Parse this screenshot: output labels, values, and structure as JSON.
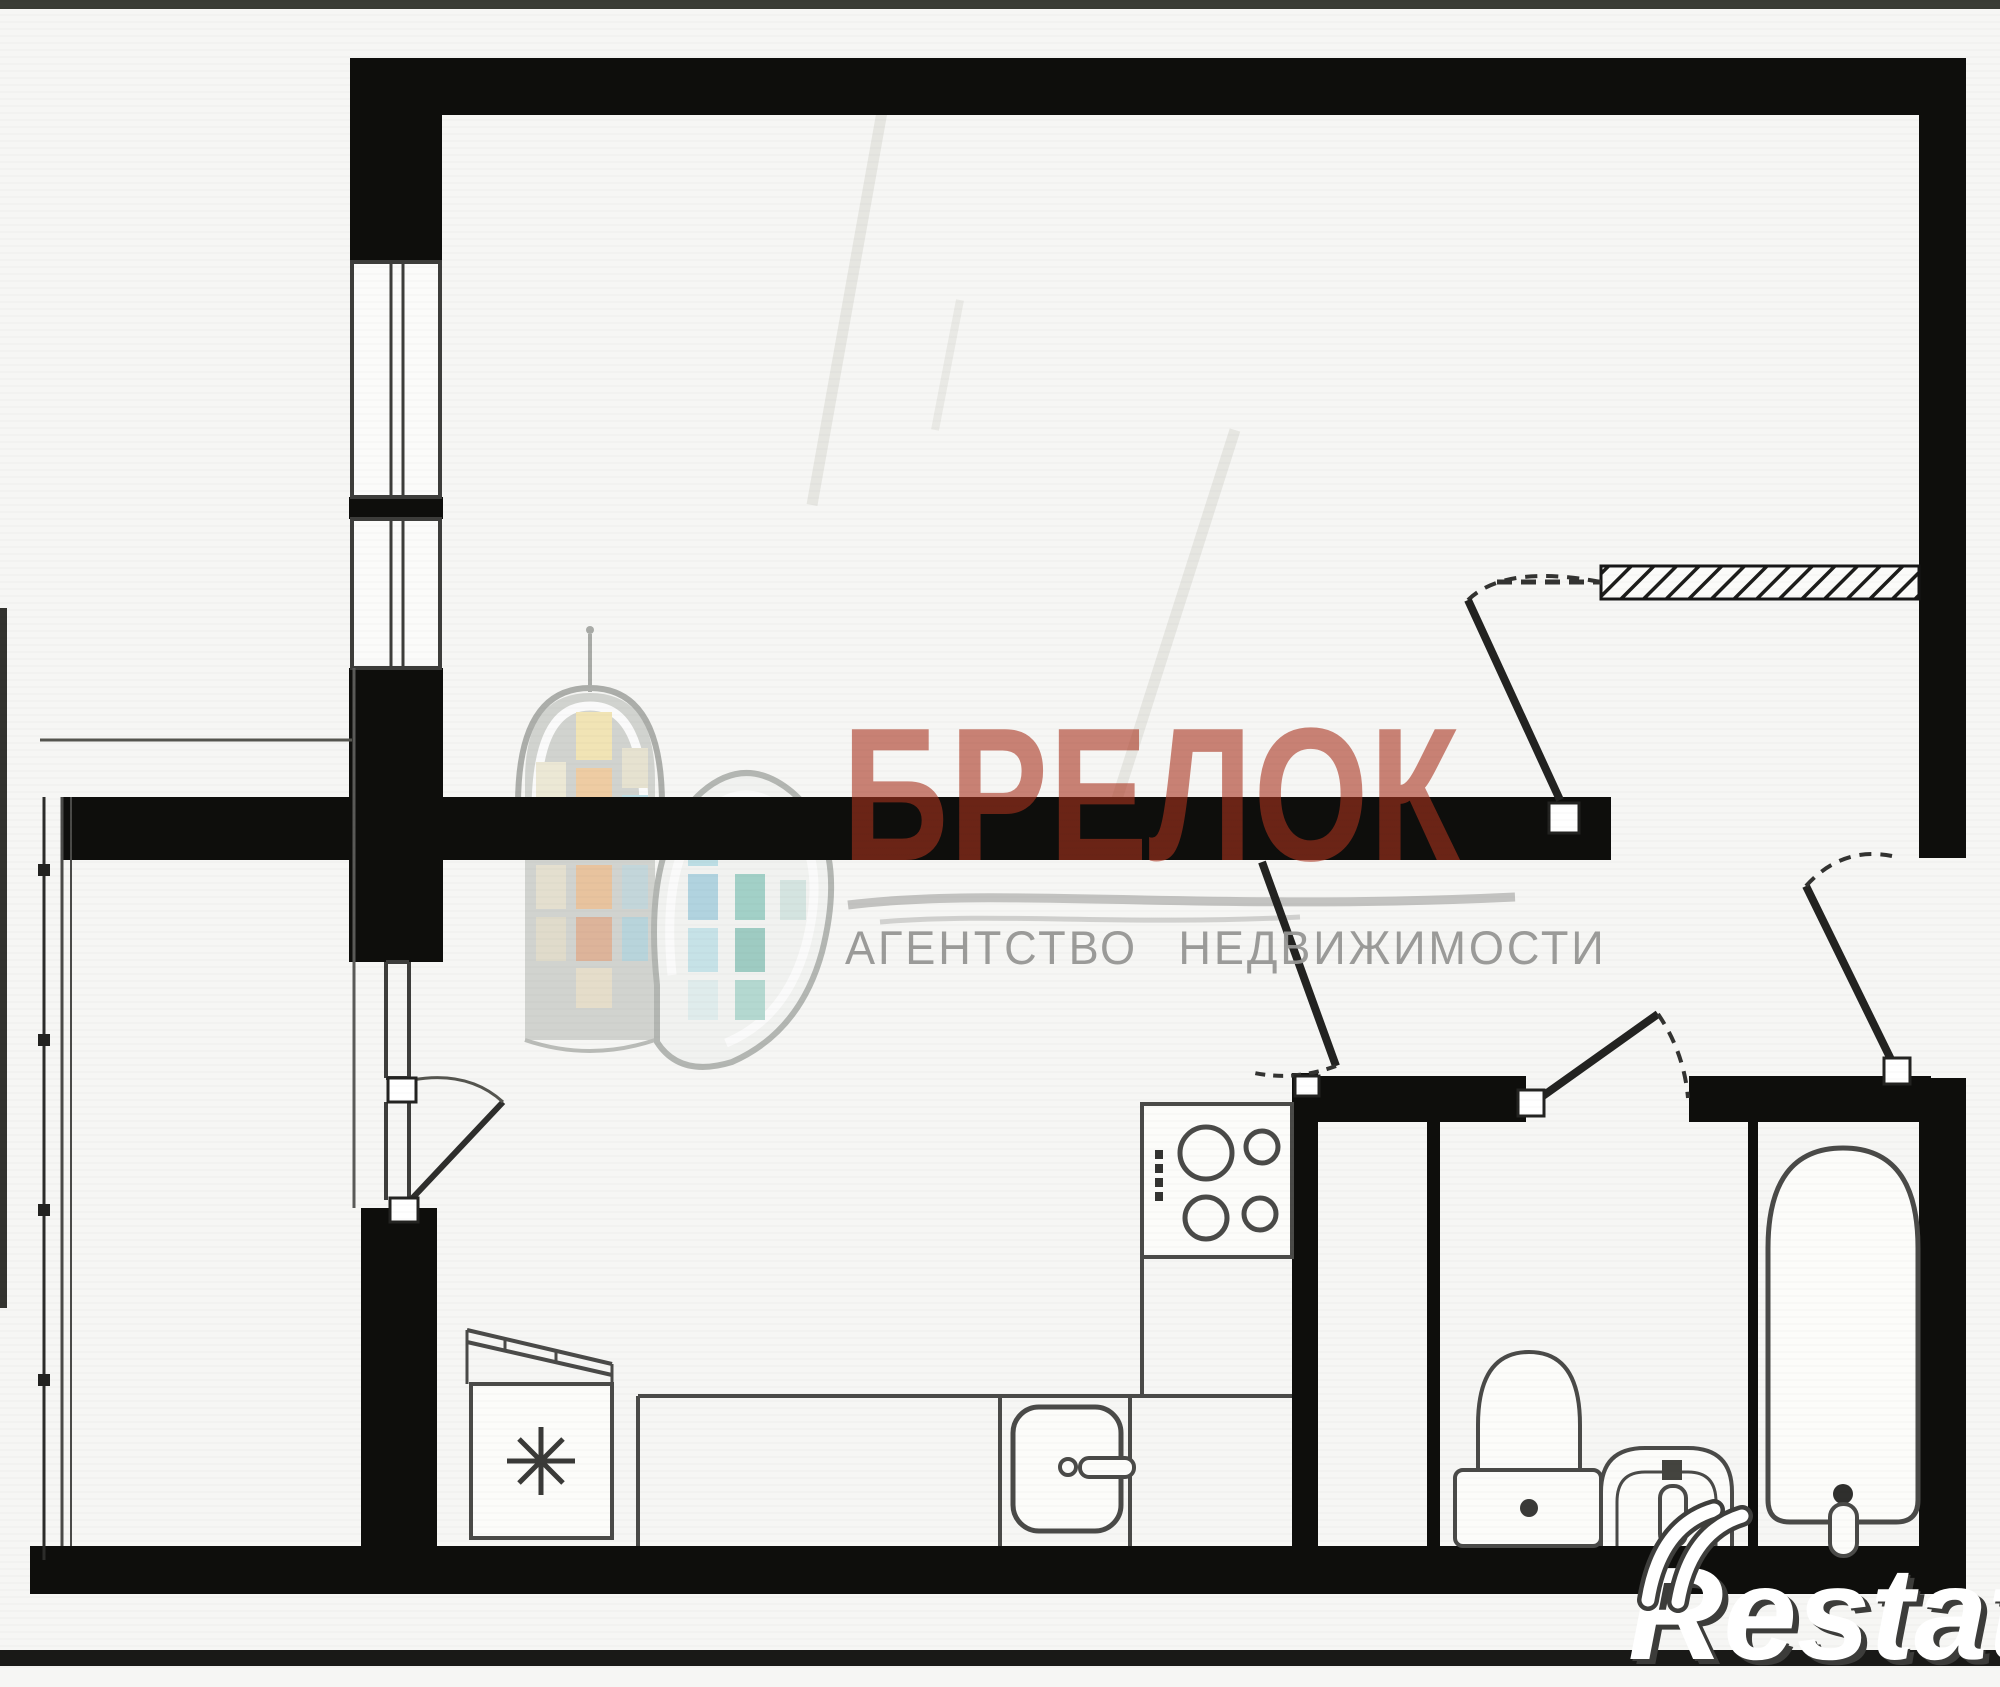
{
  "page": {
    "width": 2000,
    "height": 1669,
    "background": "#f6f6f4"
  },
  "watermark": {
    "brand_text": "БРЕЛОК",
    "tagline_text": "АГЕНТСТВО НЕДВИЖИМОСТИ",
    "brand_color": "rgba(170,52,30,0.60)",
    "tagline_color": "rgba(150,150,148,0.95)"
  },
  "agency_logo": {
    "name": "building-towers-logo",
    "window_colors": [
      "#eed783",
      "#e8aa62",
      "#8ec9d8",
      "#5fb2a4"
    ]
  },
  "corner_logo": {
    "text": "Restate",
    "fill": "#ffffff",
    "shadow": "#3c3c3a"
  },
  "floor_plan": {
    "wall_color": "#0e0e0c",
    "line_color": "#4a4a48",
    "elements": [
      "balcony",
      "living-room",
      "kitchen",
      "hallway",
      "bathroom",
      "wc",
      "entry-door",
      "window",
      "balcony-door",
      "fridge",
      "stove",
      "kitchen-sink",
      "toilet",
      "wash-basin",
      "bathtub"
    ]
  }
}
